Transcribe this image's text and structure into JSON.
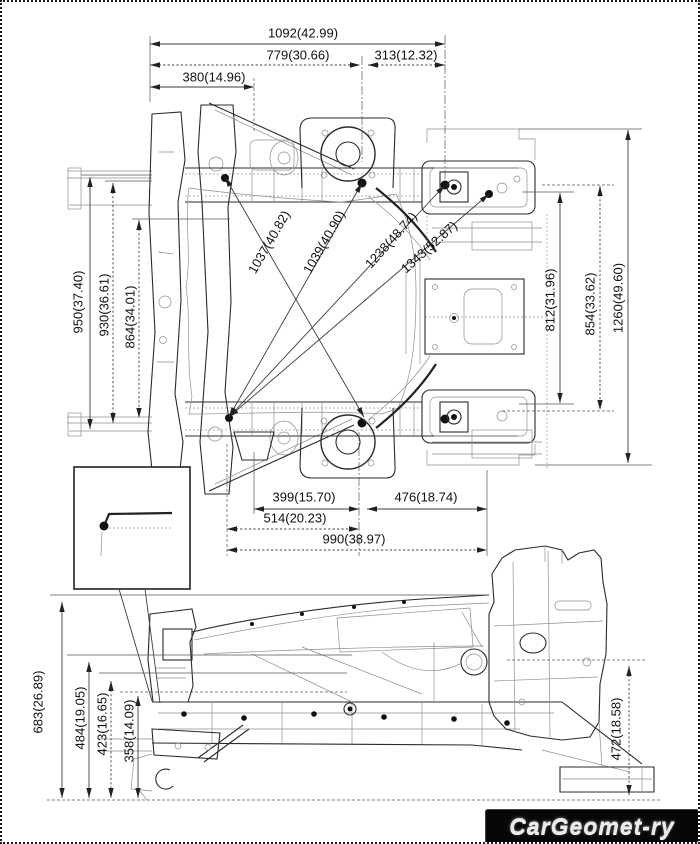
{
  "watermark": {
    "text": "CarGeomet-ry"
  },
  "dimensions": {
    "top_horizontal": [
      "1092(42.99)",
      "779(30.66)",
      "313(12.32)",
      "380(14.96)"
    ],
    "top_view_left": [
      "950(37.40)",
      "930(36.61)",
      "864(34.01)"
    ],
    "top_view_diagonal": [
      "1037(40.82)",
      "1039(40.90)",
      "1238(48.74)",
      "1343(52.87)"
    ],
    "top_view_right": [
      "812(31.96)",
      "854(33.62)",
      "1260(49.60)"
    ],
    "top_view_bottom": [
      "399(15.70)",
      "476(18.74)",
      "514(20.23)",
      "990(38.97)"
    ],
    "side_view_left": [
      "683(26.89)",
      "484(19.05)",
      "423(16.65)",
      "358(14.09)"
    ],
    "side_view_right": [
      "472(18.58)"
    ]
  }
}
